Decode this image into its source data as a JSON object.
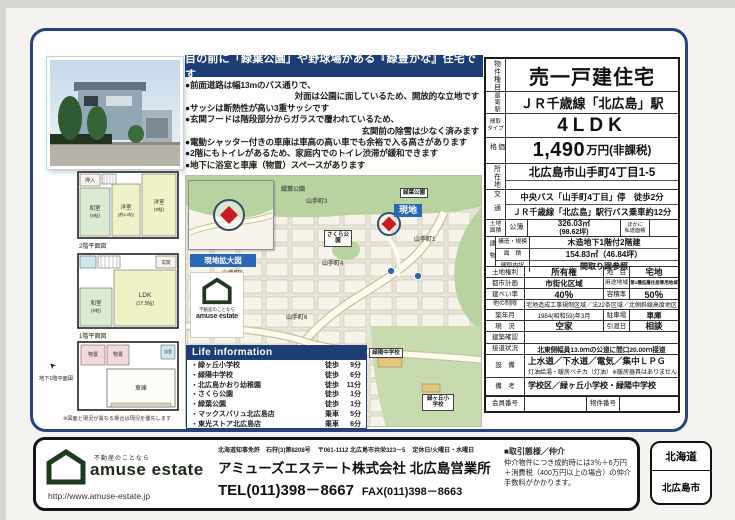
{
  "colors": {
    "navy": "#1d3e74",
    "site_blue": "#2a67b4",
    "marker_red": "#c81a20",
    "logo_green": "#1c2b1c",
    "map_park": "#b9d3a0"
  },
  "headline": {
    "title": "目の前に「緑葉公園」や野球場がある『緑豊かな』住宅です",
    "features": [
      "●前面道路は幅13mのバス通りで、",
      "対面は公園に面しているため、開放的な立地です",
      "●サッシは断熱性が高い3重サッシです",
      "●玄関フードは階段部分からガラスで覆われているため、",
      "玄関前の除雪は少なく済みます",
      "●電動シャッター付きの車庫は車高の高い車でも余裕で入る高さがあります",
      "●2階にもトイレがあるため、家庭内でのトイレ渋滞が緩和できます",
      "●地下に浴室と車庫（物置）スペースがあります"
    ]
  },
  "floorplans": {
    "f2": {
      "label": "2階平面図",
      "rooms": {
        "oshiire": "押入",
        "washitsu": "和室",
        "washitsu_size": "(6帖)",
        "yo1": "洋室",
        "yo1_size": "(約5.8帖)",
        "yo2": "洋室",
        "yo2_size": "(9帖)"
      }
    },
    "f1": {
      "label": "1階平面図",
      "rooms": {
        "genkan": "玄関",
        "washitsu": "和室",
        "washitsu_size": "(6帖)",
        "ldk": "LDK",
        "ldk_size": "(17.5帖)"
      }
    },
    "b1": {
      "label": "地下1階平面図",
      "rooms": {
        "monooki1": "物置",
        "monooki2": "物置",
        "bath": "浴室",
        "garage": "車庫"
      }
    },
    "note": "※図面と現況が異なる場合は現況を優先します"
  },
  "map": {
    "inset_label": "現地拡大図",
    "park_name": "緑葉公園",
    "park_callout": "緑葉公園",
    "site_label": "現地",
    "sakura_park": "さくら公園",
    "district1": "山手町1",
    "district3": "山手町3",
    "district4": "山手町4",
    "district5": "山手町5",
    "district6": "山手町6",
    "junior_high": "緑陽中学校",
    "elementary": "緑ヶ丘小学校",
    "logo_tagline": "不動産のことなら",
    "logo_name": "amuse estate"
  },
  "life_info": {
    "header": "Life information",
    "items": [
      {
        "name": "・緑ヶ丘小学校",
        "mode": "徒歩",
        "min": "9分"
      },
      {
        "name": "・緑陽中学校",
        "mode": "徒歩",
        "min": "6分"
      },
      {
        "name": "・北広島かおり幼稚園",
        "mode": "徒歩",
        "min": "11分"
      },
      {
        "name": "・さくら公園",
        "mode": "徒歩",
        "min": "1分"
      },
      {
        "name": "・緑葉公園",
        "mode": "徒歩",
        "min": "1分"
      },
      {
        "name": "・マックスバリュ北広島店",
        "mode": "乗車",
        "min": "5分"
      },
      {
        "name": "・東光ストア北広島店",
        "mode": "乗車",
        "min": "6分"
      }
    ]
  },
  "details": {
    "type": {
      "label": "物件種目",
      "value": "売一戸建住宅"
    },
    "station": {
      "label": "最寄駅",
      "value": "ＪＲ千歳線「北広島」駅"
    },
    "layout": {
      "label": "間取\nタイプ",
      "value": "4LDK"
    },
    "price": {
      "label": "価格",
      "value": "1,490",
      "unit": "万円(非課税)"
    },
    "address": {
      "label": "所在地",
      "value": "北広島市山手町4丁目1-5"
    },
    "transport": {
      "label": "交通",
      "line1": "中央バス「山手町4丁目」停　徒歩2分",
      "line2": "ＪＲ千歳線「北広島」駅行バス乗車約12分"
    },
    "land": {
      "label": "土地\n面積",
      "register": "公簿",
      "area": "326.03㎡",
      "tsubo": "(98.62坪)",
      "other": "ほかに\n私道面積"
    },
    "building": {
      "label": "建物",
      "structure_label": "構造・規模",
      "structure": "木造地下1階付2階建",
      "area_label": "面　積",
      "area": "154.83㎡（46.84坪）",
      "layout_label": "間取内訳",
      "layout": "間取り図参照"
    },
    "rights": {
      "label": "土地権利",
      "value": "所有権",
      "label2": "地　目",
      "value2": "宅地"
    },
    "cityplan": {
      "label": "都市計画",
      "value": "市街化区域",
      "label2": "用途地域",
      "value2": "第1種低層住居専用地域"
    },
    "ratio": {
      "label": "建ぺい率",
      "value": "40％",
      "label2": "容積率",
      "value2": "50％"
    },
    "restrictions": {
      "label": "他の制限",
      "value": "宅地造成工事規制区域／法22条区域／北側斜線高度地区"
    },
    "built": {
      "label": "築年月",
      "value": "1984(昭和59)年3月",
      "label2": "駐車場",
      "value2": "車庫"
    },
    "status": {
      "label": "現　況",
      "value": "空家",
      "label2": "引渡日",
      "value2": "相談"
    },
    "confirmation": {
      "label": "建築確認",
      "value": ""
    },
    "road": {
      "label": "接道状況",
      "value": "北東側幅員13.0ｍの公道に間口20.00ｍ接道"
    },
    "equipment": {
      "label": "設　備",
      "line1": "上水道／下水道／電気／集中ＬＰＧ",
      "line2": "灯油給湯・暖房ペチカ（灯油）※暖房器具はありません"
    },
    "remarks": {
      "label": "備　考",
      "value": "学校区／緑ヶ丘小学校・緑陽中学校"
    },
    "numbers": {
      "label": "会員番号",
      "label2": "物件番号"
    }
  },
  "footer": {
    "license": "北海道知事免許　石狩(3)第8208号",
    "address": "〒061-1112 北広島市共栄323－5",
    "holiday": "定休日/火曜日・水曜日",
    "company": "アミューズエステート株式会社 北広島営業所",
    "tel": "TEL(011)398－8667",
    "fax": "FAX(011)398－8663",
    "logo_tagline": "不動産のことなら",
    "logo_name": "amuse estate",
    "url": "http://www.amuse-estate.jp",
    "deal_title": "■取引態様／仲介",
    "deal_body": "仲介物件につき成約時には3％＋6万円＋消費税（400万円以上の場合）の仲介手数料がかかります。"
  },
  "badge": {
    "prefecture": "北海道",
    "city": "北広島市"
  }
}
